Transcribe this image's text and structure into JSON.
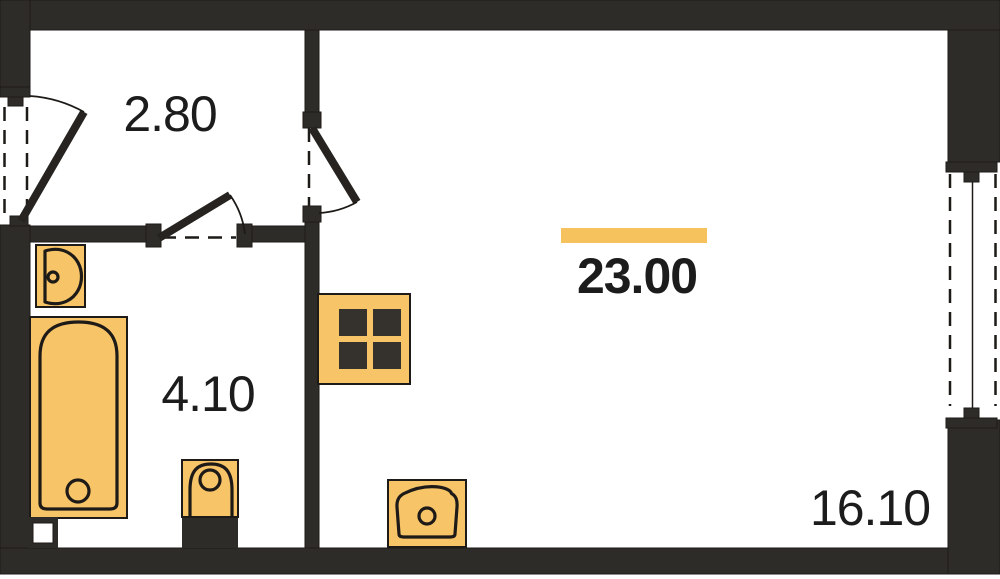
{
  "plan": {
    "type": "apartment-floor-plan",
    "rooms": {
      "hallway": {
        "area": "2.80"
      },
      "bathroom": {
        "area": "4.10"
      },
      "studio": {
        "area": "23.00",
        "highlighted": true
      },
      "living": {
        "area": "16.10"
      }
    },
    "fixtures": [
      "entrance-door",
      "bathroom-door",
      "living-room-door",
      "bathroom-sink",
      "bathtub",
      "toilet",
      "stove",
      "kitchen-sink",
      "ventilation-shaft",
      "window"
    ]
  },
  "colors": {
    "wall": "#2e2c29",
    "outline": "#1d1a17",
    "fixture": "#f8c468",
    "burner": "#35322d",
    "highlight": "#f6c25e",
    "background": "#ffffff",
    "text": "#1c1c1c"
  }
}
